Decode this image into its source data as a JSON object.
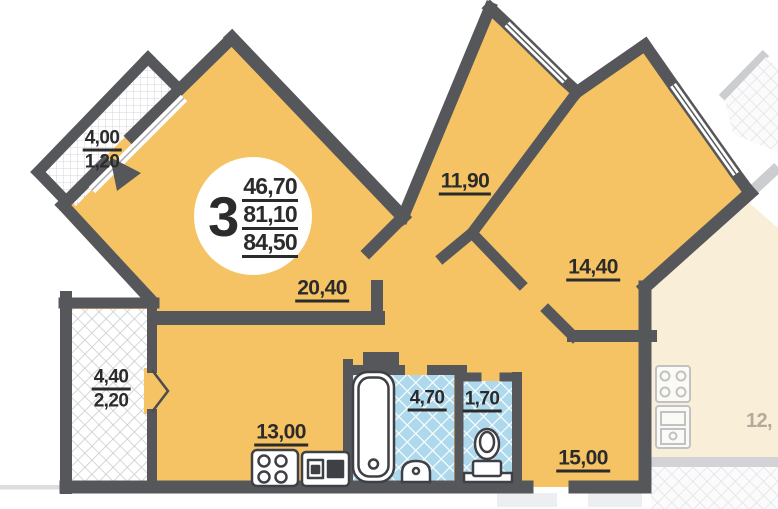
{
  "plan": {
    "badge": {
      "room_count": "3",
      "areas": [
        "46,70",
        "81,10",
        "84,50"
      ]
    },
    "labels": {
      "balcony_top_left": {
        "line1": "4,00",
        "line2": "1,20"
      },
      "living_room": "20,40",
      "bedroom_middle": "11,90",
      "bedroom_right": "14,40",
      "balcony_left": {
        "line1": "4,40",
        "line2": "2,20"
      },
      "kitchen": "13,00",
      "bathroom": "4,70",
      "wc": "1,70",
      "hall": "15,00",
      "neighbor_partial": "12,"
    },
    "fixtures": [
      "stove",
      "kitchen-sink",
      "bathtub",
      "wash-basin",
      "toilet"
    ],
    "colors": {
      "wall": "#56575b",
      "room": "#f5c364",
      "tile": "#aed9ec",
      "neighbor": "#f8ecd2"
    }
  }
}
